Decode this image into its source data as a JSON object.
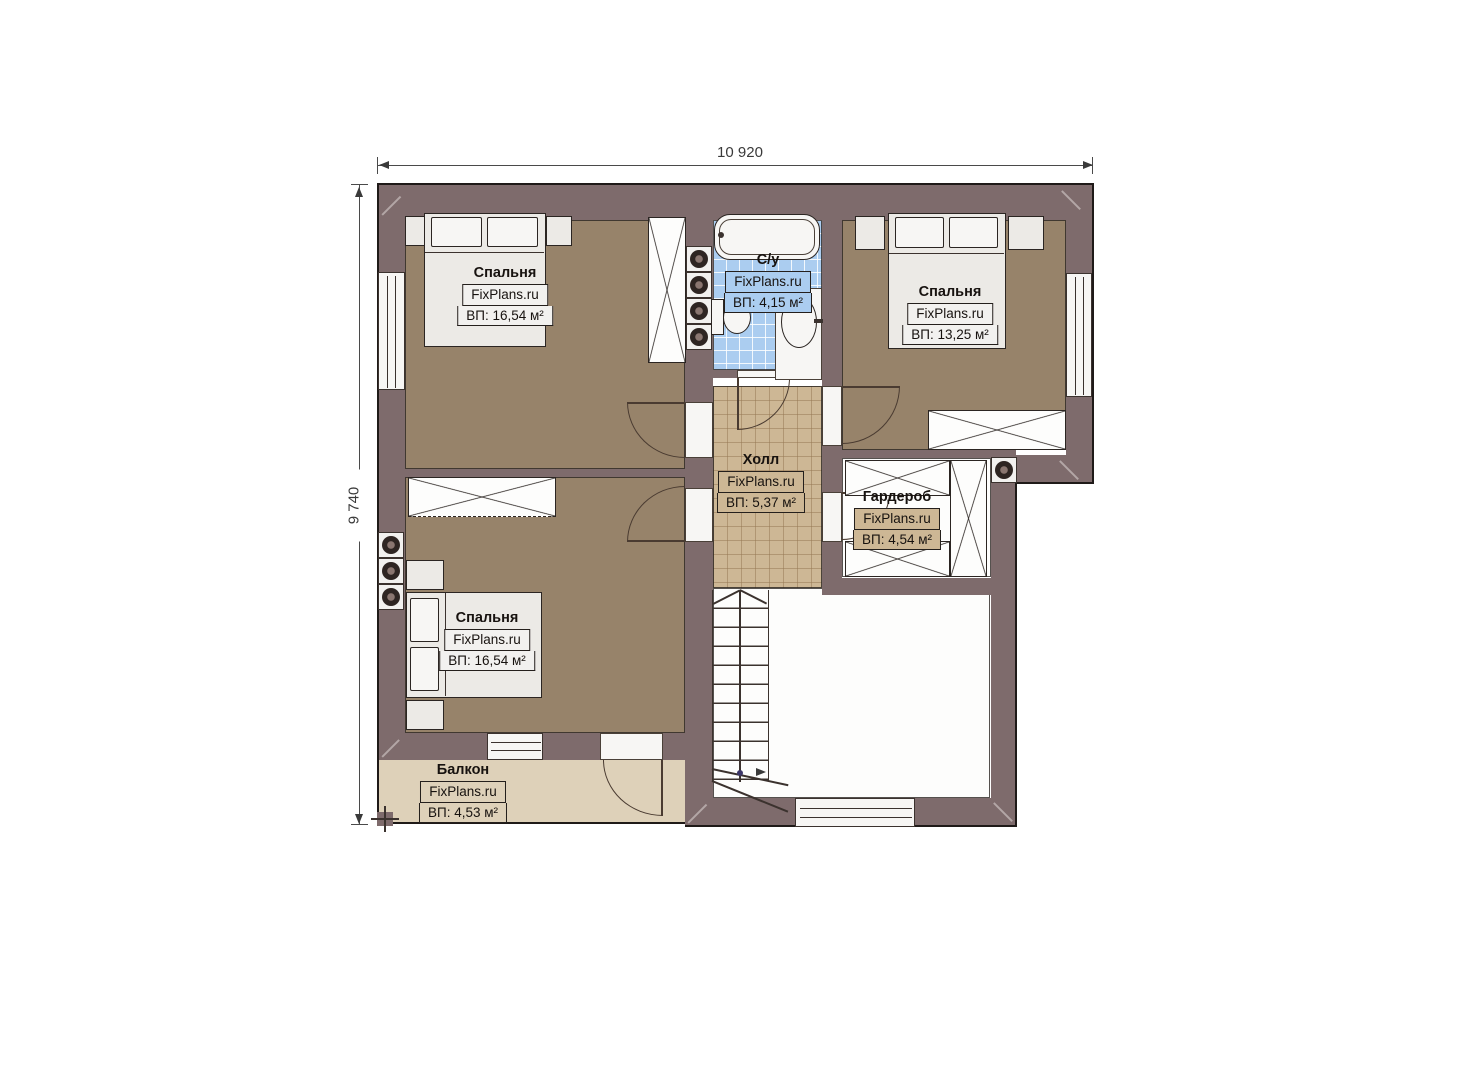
{
  "plan": {
    "dimensions": {
      "width_label": "10 920",
      "height_label": "9 740"
    },
    "brand": "FixPlans.ru",
    "rooms": [
      {
        "key": "bedroom_top_left",
        "name": "Спальня",
        "brand": "FixPlans.ru",
        "area": "ВП: 16,54 м²"
      },
      {
        "key": "bathroom",
        "name": "С/у",
        "brand": "FixPlans.ru",
        "area": "ВП: 4,15 м²"
      },
      {
        "key": "bedroom_top_right",
        "name": "Спальня",
        "brand": "FixPlans.ru",
        "area": "ВП: 13,25 м²"
      },
      {
        "key": "hall",
        "name": "Холл",
        "brand": "FixPlans.ru",
        "area": "ВП: 5,37 м²"
      },
      {
        "key": "wardrobe_room",
        "name": "Гардероб",
        "brand": "FixPlans.ru",
        "area": "ВП: 4,54 м²"
      },
      {
        "key": "bedroom_bottom_left",
        "name": "Спальня",
        "brand": "FixPlans.ru",
        "area": "ВП: 16,54 м²"
      },
      {
        "key": "balcony",
        "name": "Балкон",
        "brand": "FixPlans.ru",
        "area": "ВП: 4,53 м²"
      }
    ],
    "colors": {
      "wall": "#7e6b6c",
      "bedroom_floor": "#97836a",
      "hall_floor": "#cdb795",
      "bath_floor": "#abcdf0",
      "balcony_floor": "#ded1b9",
      "outline": "#2b2522"
    }
  }
}
